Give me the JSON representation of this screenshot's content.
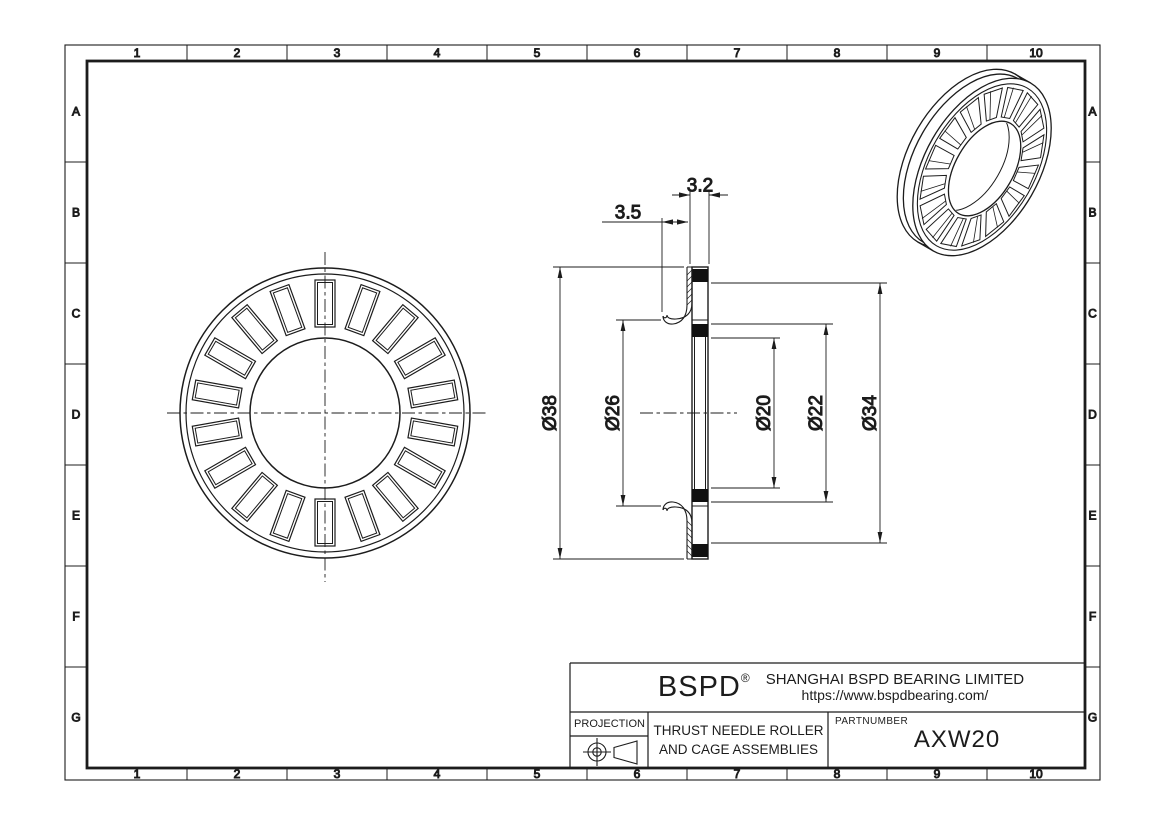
{
  "drawing": {
    "grid": {
      "columns": [
        "1",
        "2",
        "3",
        "4",
        "5",
        "6",
        "7",
        "8",
        "9",
        "10"
      ],
      "rows": [
        "A",
        "B",
        "C",
        "D",
        "E",
        "F",
        "G"
      ]
    },
    "dimensions": {
      "d38": "Ø38",
      "d26": "Ø26",
      "d20": "Ø20",
      "d22": "Ø22",
      "d34": "Ø34",
      "d35": "3.5",
      "d32": "3.2"
    },
    "front_view": {
      "roller_count": 18
    },
    "iso_view": {
      "roller_count": 16
    },
    "colors": {
      "line": "#1c1c1c",
      "background": "#ffffff",
      "section_fill": "#111111"
    }
  },
  "title_block": {
    "logo": "BSPD",
    "registered_mark": "®",
    "company_name": "SHANGHAI BSPD BEARING LIMITED",
    "website": "https://www.bspdbearing.com/",
    "projection_label": "PROJECTION",
    "part_title_line1": "THRUST NEEDLE ROLLER",
    "part_title_line2": "AND CAGE ASSEMBLIES",
    "partnumber_label": "PARTNUMBER",
    "partnumber": "AXW20"
  }
}
